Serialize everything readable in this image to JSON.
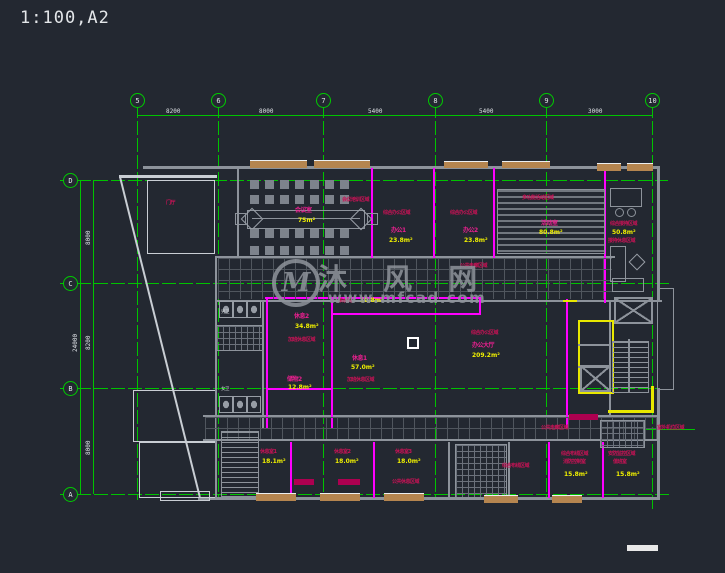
{
  "app": {
    "title": "1:100,A2"
  },
  "colors": {
    "background": "#232831",
    "grid_green": "#00c300",
    "wall_gray": "#8d939b",
    "wall_magenta": "#ff00ff",
    "highlight_yellow": "#e8e800",
    "label_red": "#cb1256",
    "room_name_magenta": "#ea1f8f",
    "area_yellow": "#f0f000",
    "dimension_white": "#dde1e5",
    "watermark_gray": "#8f949b"
  },
  "grid": {
    "col_labels": [
      "5",
      "6",
      "7",
      "8",
      "9",
      "10"
    ],
    "row_labels": [
      "D",
      "C",
      "B",
      "A"
    ],
    "top_dims": [
      "8200",
      "8000",
      "5400",
      "5400",
      "3000"
    ],
    "left_dims": [
      "8000",
      "8200",
      "8000"
    ],
    "left_total": "24000"
  },
  "watermark": {
    "logo": "M",
    "name": "沐 风 网",
    "url": "www.mfcad.com"
  },
  "labels": [
    {
      "t": "门厅",
      "role": "room-name"
    },
    {
      "t": "会议室",
      "role": "room-name"
    },
    {
      "t": "75m²",
      "role": "room-area"
    },
    {
      "t": "会议培训区域",
      "role": "zone"
    },
    {
      "t": "综合办公区域",
      "role": "zone"
    },
    {
      "t": "办公1",
      "role": "room-name"
    },
    {
      "t": "23.8m²",
      "role": "room-area"
    },
    {
      "t": "综合办公区域",
      "role": "zone"
    },
    {
      "t": "办公2",
      "role": "room-name"
    },
    {
      "t": "23.8m²",
      "role": "room-area"
    },
    {
      "t": "多功能活动区域",
      "role": "zone"
    },
    {
      "t": "活动室",
      "role": "room-name"
    },
    {
      "t": "80.8m²",
      "role": "room-area"
    },
    {
      "t": "综合接待区域",
      "role": "zone"
    },
    {
      "t": "50.8m²",
      "role": "room-area"
    },
    {
      "t": "接待休息区域",
      "role": "zone"
    },
    {
      "t": "公共走廊区域",
      "role": "zone"
    },
    {
      "t": "茶水间",
      "role": "room-name"
    },
    {
      "t": "10.8m²",
      "role": "room-area"
    },
    {
      "t": "休息2",
      "role": "room-name"
    },
    {
      "t": "34.8m²",
      "role": "room-area"
    },
    {
      "t": "加班休息区域",
      "role": "zone"
    },
    {
      "t": "休息1",
      "role": "room-name"
    },
    {
      "t": "57.0m²",
      "role": "room-area"
    },
    {
      "t": "加班休息区域",
      "role": "zone"
    },
    {
      "t": "储物2",
      "role": "room-name"
    },
    {
      "t": "12.8m²",
      "role": "room-area"
    },
    {
      "t": "综合办公区域",
      "role": "zone"
    },
    {
      "t": "办公大厅",
      "role": "room-name"
    },
    {
      "t": "209.2m²",
      "role": "room-area"
    },
    {
      "t": "休息室1",
      "role": "room-name"
    },
    {
      "t": "18.1m²",
      "role": "room-area"
    },
    {
      "t": "休息室2",
      "role": "room-name"
    },
    {
      "t": "18.0m²",
      "role": "room-area"
    },
    {
      "t": "休息室3",
      "role": "room-name"
    },
    {
      "t": "18.0m²",
      "role": "room-area"
    },
    {
      "t": "公共休息区域",
      "role": "zone"
    },
    {
      "t": "综合布线区域",
      "role": "zone"
    },
    {
      "t": "公共走廊区域",
      "role": "zone"
    },
    {
      "t": "综合布线区域",
      "role": "zone"
    },
    {
      "t": "消防控制室",
      "role": "room-name"
    },
    {
      "t": "15.8m²",
      "role": "room-area"
    },
    {
      "t": "安防监控区域",
      "role": "zone"
    },
    {
      "t": "值班室",
      "role": "room-name"
    },
    {
      "t": "15.8m²",
      "role": "room-area"
    },
    {
      "t": "室外机位区域",
      "role": "annotation"
    },
    {
      "t": "男卫",
      "role": "room-name"
    },
    {
      "t": "女卫",
      "role": "room-name"
    }
  ]
}
